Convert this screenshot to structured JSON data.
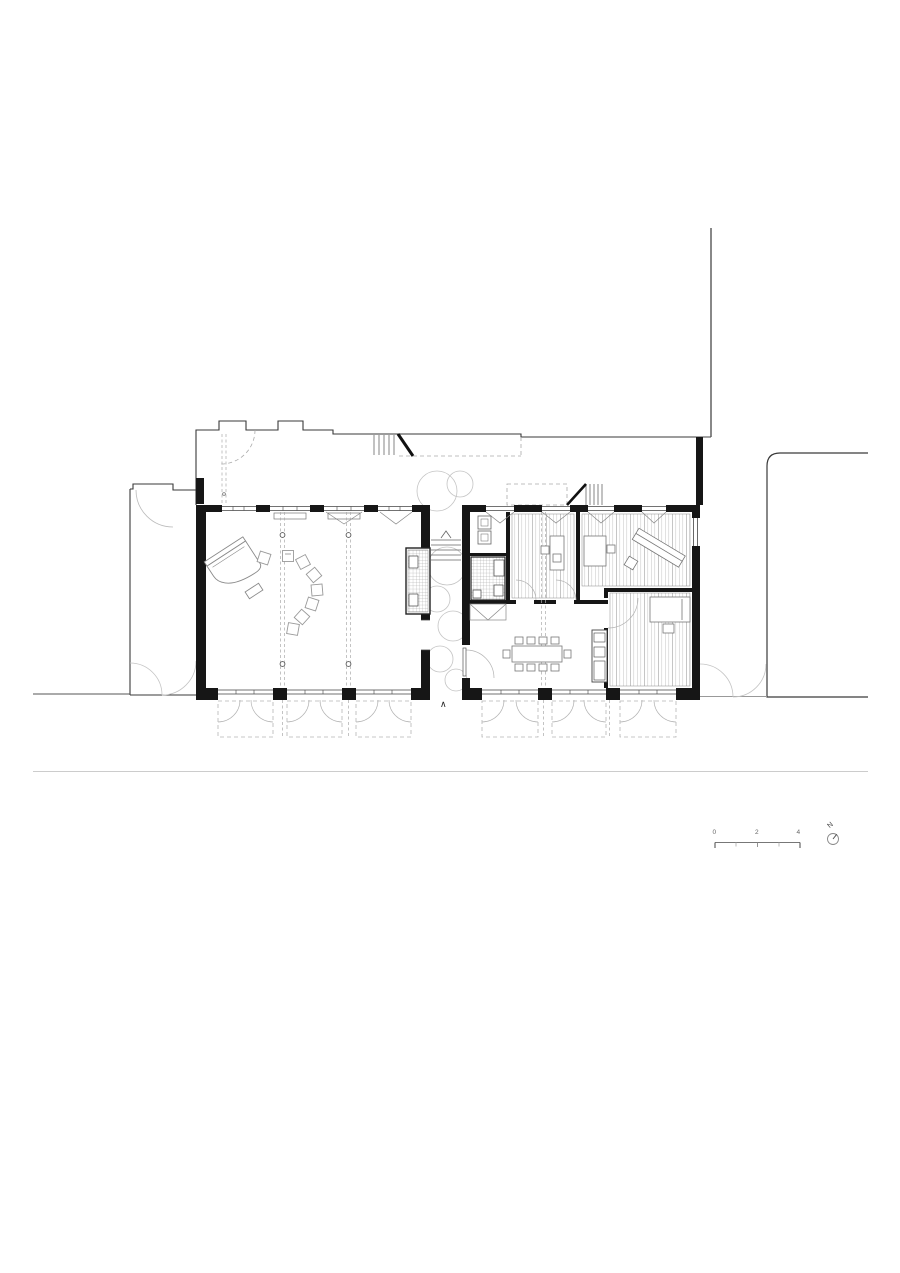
{
  "drawing": {
    "kind": "architectural-floor-plan",
    "colors": {
      "background": "#ffffff",
      "wall": "#161616",
      "outline": "#3a3a3a",
      "thin_line": "#777777",
      "hatch": "#b5b5b5",
      "dashed": "#aaaaaa",
      "vegetation": "#c4c4c4",
      "annotation": "#666666"
    }
  },
  "scale_bar": {
    "labels": [
      "0",
      "2",
      "4"
    ]
  },
  "north_indicator": {
    "label": "N"
  },
  "section_marker": {
    "label": "∧"
  }
}
